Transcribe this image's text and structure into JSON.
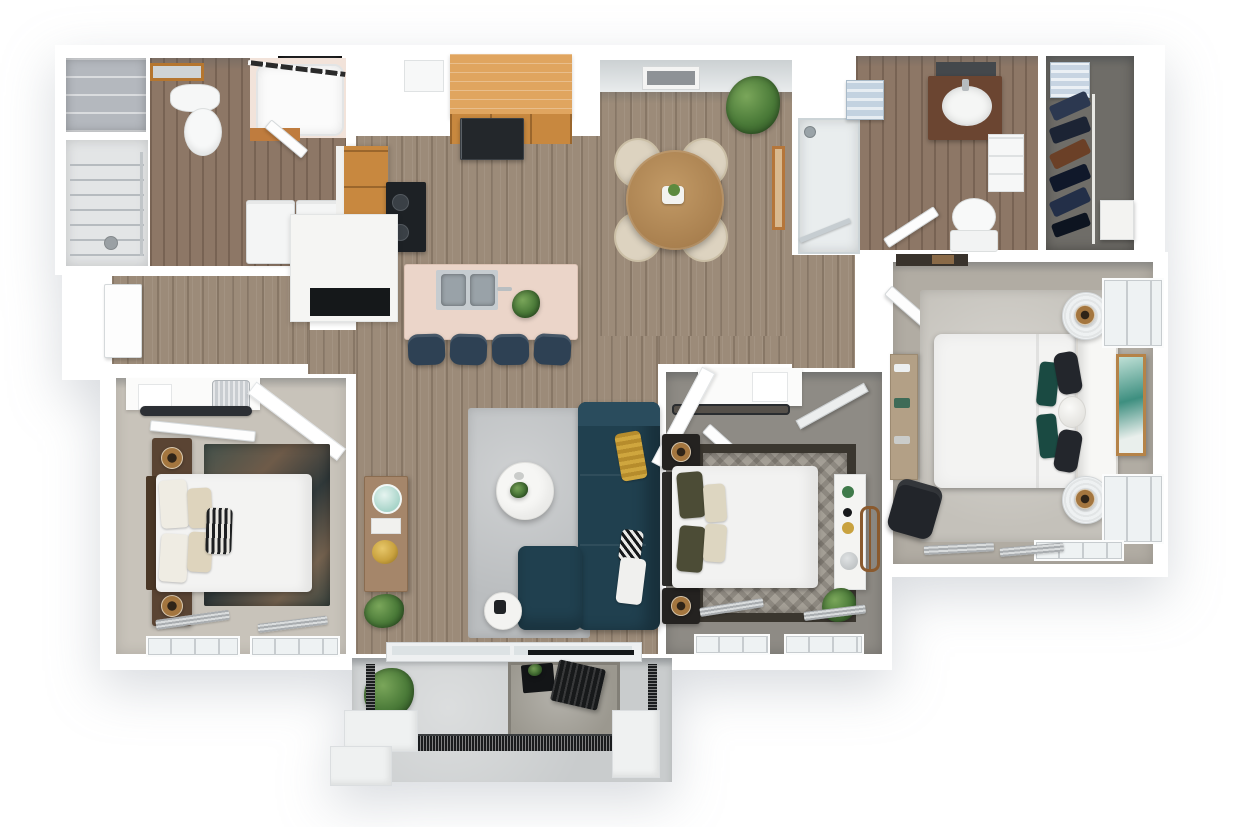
{
  "meta": {
    "title": "3D apartment floor plan rendering",
    "description": "Top-down 3D dollhouse rendering of a three-bedroom, two-bathroom apartment with an open kitchen, dining and living area, laundry room, walk-in closet and a private patio",
    "bedrooms": 3,
    "bathrooms": 2,
    "visible_text": "none"
  },
  "palette": {
    "background": "#ffffff",
    "walls": "#ffffff",
    "wood_floor": "#9c8b79",
    "bath_wood_floor": "#8d7766",
    "bedroom1_carpet": "#c8c3ba",
    "bedroom2_carpet": "#8e8b85",
    "master_carpet": "#b1aca3",
    "closet_carpet": "#6f6d68",
    "patio_concrete": "#c9cccd",
    "kitchen_cabinet_wood": "#c8883f",
    "island_counter_pink": "#ebd5c9",
    "sofa_teal": "#20404f",
    "bar_stool_navy": "#2e4154",
    "accent_gold": "#c9a23f",
    "teal_wall_art": "#3e8f80",
    "dining_table_wood": "#b08a55",
    "plant_green": "#4a7a38"
  },
  "rooms": [
    {
      "id": "linen-closet",
      "label": "Linen closet",
      "furniture": [
        "shelving unit"
      ]
    },
    {
      "id": "bathroom-1",
      "label": "Bathroom 1",
      "furniture": [
        "vanity mirror",
        "pedestal sink",
        "toilet",
        "bathtub with shower curtain rod",
        "wood cabinet",
        "water heater closet"
      ]
    },
    {
      "id": "laundry",
      "label": "Laundry / utility room",
      "furniture": [
        "wire shelving",
        "hanging rod",
        "washer",
        "dryer"
      ]
    },
    {
      "id": "hallway",
      "label": "Hallway",
      "furniture": [
        "entry door",
        "console table",
        "aqua glass lamp",
        "gold bowl",
        "potted plant"
      ]
    },
    {
      "id": "kitchen",
      "label": "Kitchen",
      "furniture": [
        "upper counter run",
        "refrigerator",
        "wall cabinet",
        "base cabinets",
        "range cooktop",
        "island base with niche",
        "pink-top kitchen island",
        "stainless double sink",
        "faucet",
        "island plant",
        "bar stool",
        "bar stool",
        "bar stool",
        "bar stool"
      ]
    },
    {
      "id": "dining-area",
      "label": "Dining area",
      "furniture": [
        "round dining table",
        "dining chair",
        "dining chair",
        "dining chair",
        "dining chair",
        "table centerpiece",
        "potted plant",
        "wall art",
        "leaning wood art frame"
      ]
    },
    {
      "id": "living-room",
      "label": "Living room",
      "furniture": [
        "gray area rug",
        "teal sectional sofa",
        "chaise",
        "gold pillow",
        "black-white striped pillow",
        "white pillow",
        "round coffee table",
        "side table",
        "wall-mounted tv",
        "sliding patio door"
      ]
    },
    {
      "id": "bedroom-1",
      "label": "Bedroom 1",
      "furniture": [
        "closet shelf",
        "storage basket",
        "hanging clothes",
        "closet door",
        "nightstand",
        "nightstand",
        "table lamp",
        "table lamp",
        "queen bed",
        "cream pillows",
        "zebra accent pillow",
        "dark patterned rug",
        "window",
        "window",
        "stacked blinds"
      ]
    },
    {
      "id": "bedroom-2",
      "label": "Bedroom 2",
      "furniture": [
        "closet shelf",
        "closet door",
        "leaning mirror",
        "nightstand",
        "nightstand",
        "gold table lamp",
        "gold table lamp",
        "queen bed",
        "olive and cream pillows",
        "diamond patterned rug",
        "white console shelf",
        "round wheel wall decor",
        "potted plant",
        "window",
        "window"
      ]
    },
    {
      "id": "master-bedroom",
      "label": "Master bedroom",
      "furniture": [
        "entry door",
        "area rug",
        "desk",
        "office chair",
        "king bed",
        "curved white headboard",
        "teal pillow",
        "black pillows",
        "white round pillow",
        "drum nightstand",
        "drum nightstand",
        "bronze lamp",
        "bronze lamp",
        "window",
        "window",
        "window",
        "teal wall art",
        "stacked blinds"
      ]
    },
    {
      "id": "bathroom-2",
      "label": "Bathroom 2",
      "furniture": [
        "walk-in shower",
        "dark wood vanity",
        "oval sink",
        "mirror",
        "toilet",
        "towel shelf",
        "wall shelf unit",
        "door"
      ]
    },
    {
      "id": "walk-in-closet",
      "label": "Walk-in closet",
      "furniture": [
        "linen stack",
        "hanging rod",
        "hanging clothes",
        "white drawer unit"
      ]
    },
    {
      "id": "patio",
      "label": "Patio / balcony",
      "furniture": [
        "concrete floor",
        "outdoor rug",
        "folding chair",
        "black side table",
        "potted plant",
        "metal mesh railing",
        "planter box",
        "planter box",
        "planter box"
      ]
    }
  ]
}
